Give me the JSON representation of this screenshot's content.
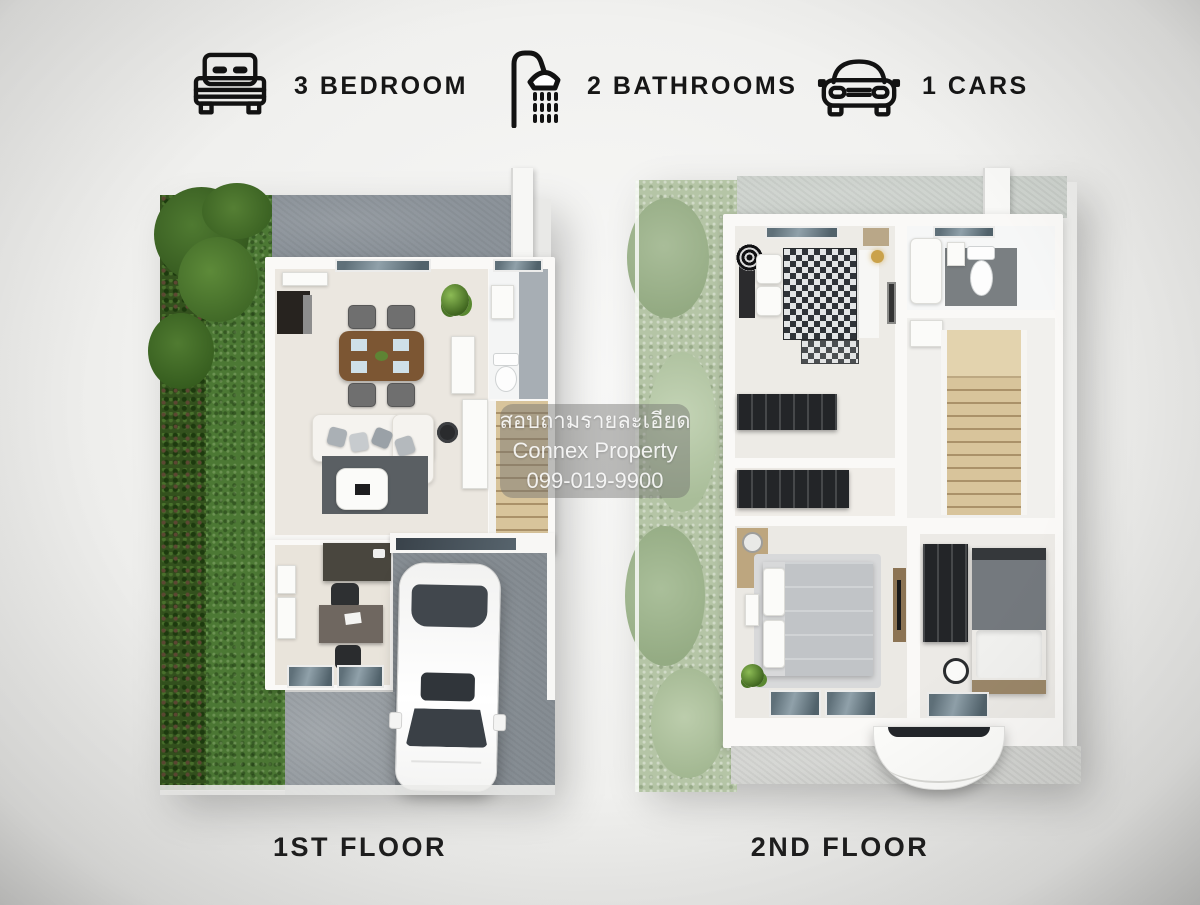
{
  "header": {
    "features": [
      {
        "icon": "bed-icon",
        "label": "3 BEDROOM"
      },
      {
        "icon": "shower-icon",
        "label": "2 BATHROOMS"
      },
      {
        "icon": "car-icon",
        "label": "1 CARS"
      }
    ]
  },
  "watermark": {
    "line1": "สอบถามรายละเอียด",
    "line2": "Connex Property",
    "line3": "099-019-9900"
  },
  "floor_plans": [
    {
      "label": "1ST FLOOR"
    },
    {
      "label": "2ND FLOOR"
    }
  ],
  "colors": {
    "background": "#f0f0ee",
    "text": "#161616",
    "grass_dark": "#4c7834",
    "grass_pale": "#b5c5a6",
    "concrete_driveway": "#8c939a",
    "concrete_light": "#d4d5d2",
    "house_wall": "#faf9f7",
    "interior_floor": "#ebe7e0",
    "wood_stairs": "#d8c49b",
    "window_glass": "#5f7079",
    "watermark_box": "rgba(112,113,110,0.45)",
    "watermark_text": "rgba(255,255,255,0.88)"
  }
}
